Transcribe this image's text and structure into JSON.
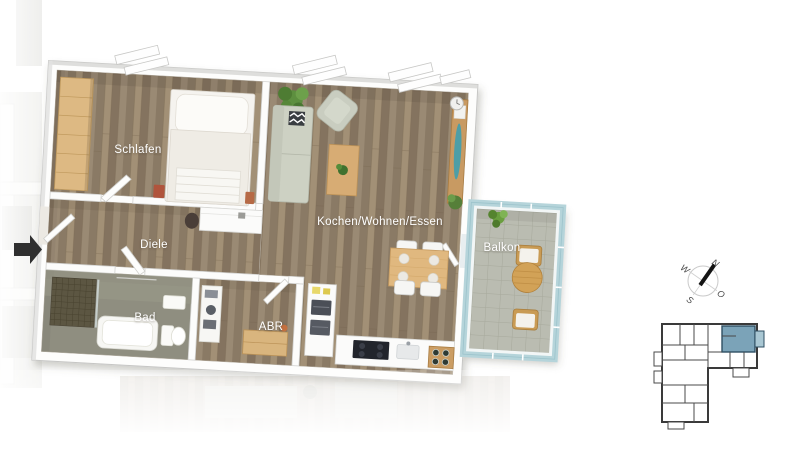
{
  "floorplan": {
    "type": "3d-apartment-floor-plan",
    "rooms": [
      {
        "id": "schlafen",
        "label": "Schlafen"
      },
      {
        "id": "diele",
        "label": "Diele"
      },
      {
        "id": "bad",
        "label": "Bad"
      },
      {
        "id": "abr",
        "label": "ABR"
      },
      {
        "id": "kochen-wohnen-essen",
        "label": "Kochen/Wohnen/Essen"
      },
      {
        "id": "balkon",
        "label": "Balkon"
      }
    ]
  },
  "compass": {
    "n": "N",
    "o": "O",
    "s": "S",
    "w": "W"
  },
  "icons": {
    "entrance": "entrance-arrow-icon",
    "compass": "compass-rose-icon",
    "keyplan": "building-key-plan"
  },
  "colors": {
    "wood_floor": "#93836f",
    "bath_floor": "#8f8e80",
    "balcony_glass": "#b5d4da",
    "balcony_floor": "#b9bbb1",
    "wardrobe_wood": "#ddb983",
    "table_wood": "#d7ac74",
    "sofa": "#cdd1c3",
    "keyplan_highlight": "#7ba3b8",
    "keyplan_balcony": "#a9c7d3",
    "keyplan_wall": "#3a3a3a",
    "entrance_arrow": "#2f2f2f",
    "label_text": "#ffffff"
  }
}
